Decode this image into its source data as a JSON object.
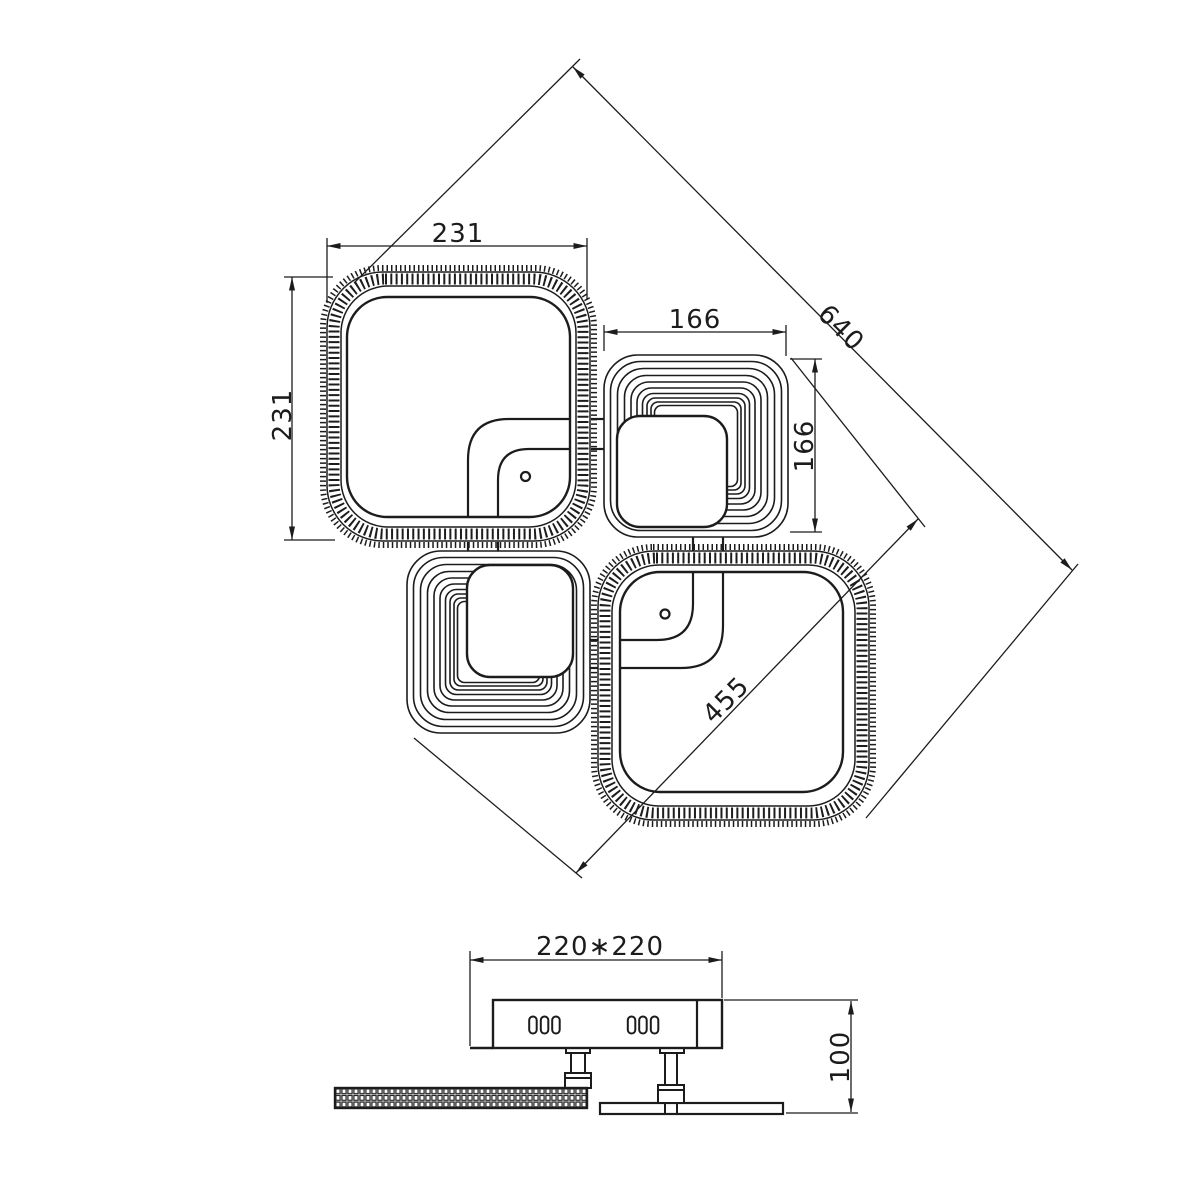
{
  "drawing": {
    "background": "#ffffff",
    "line_color": "#1c1c1c",
    "top_view": {
      "dim_width": "231",
      "dim_height": "231",
      "dim_small_width": "166",
      "dim_small_height": "166",
      "dim_diagonal_overall": "640",
      "dim_diagonal_inner": "455"
    },
    "side_view": {
      "dim_canopy": "220∗220",
      "dim_height": "100"
    }
  }
}
